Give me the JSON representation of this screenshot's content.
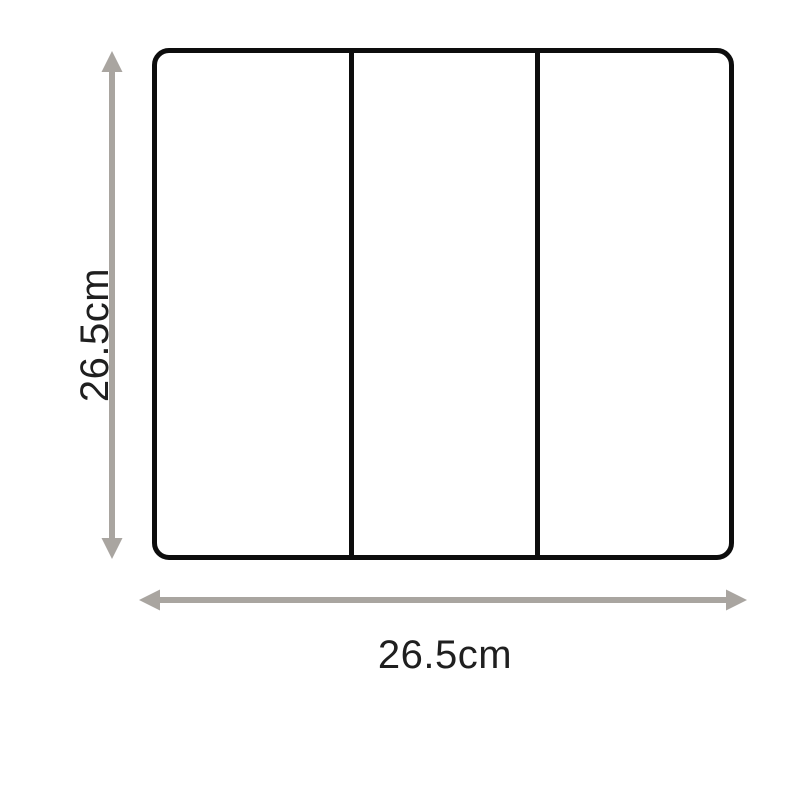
{
  "diagram": {
    "type": "product-dimension-diagram",
    "shape": "rounded rectangle divided into 3 vertical panels",
    "panel_count": 3,
    "height_label": "26.5cm",
    "width_label": "26.5cm",
    "colors": {
      "outline": "#0d0d0d",
      "divider": "#0d0d0d",
      "arrow": "#a9a5a0",
      "label_text": "#1f1f1f",
      "background": "#ffffff"
    }
  }
}
